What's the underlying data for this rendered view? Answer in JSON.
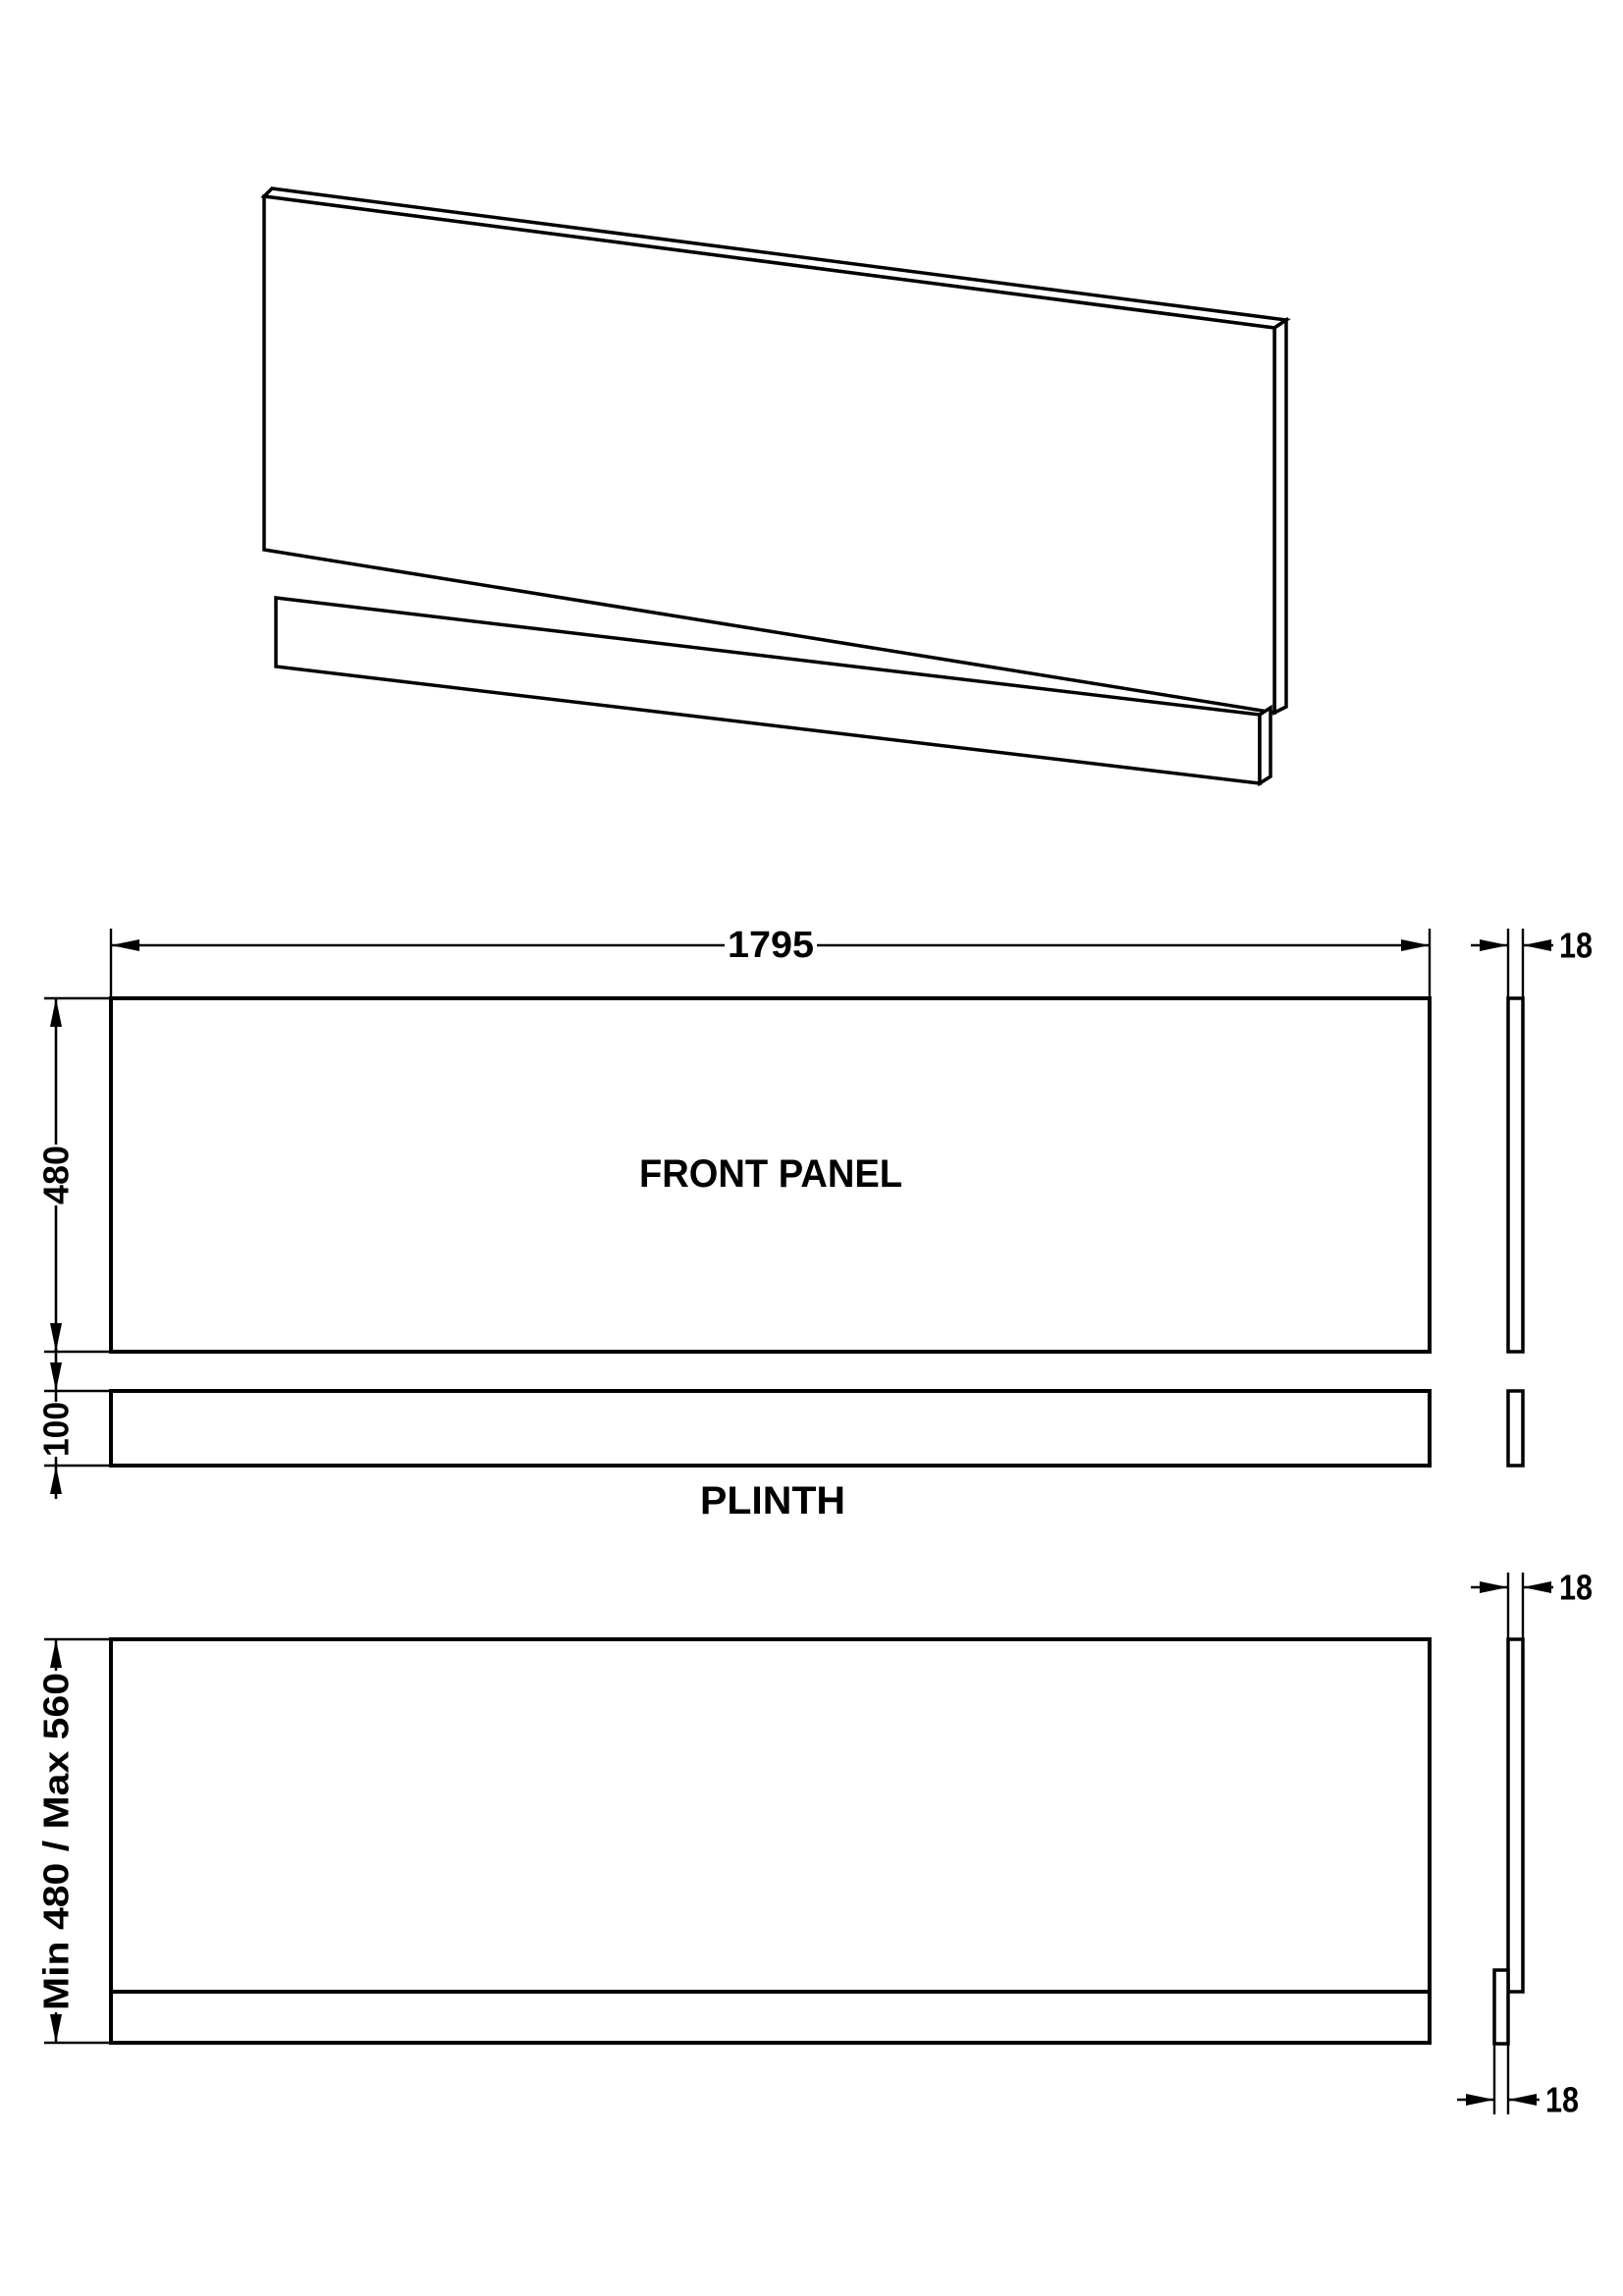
{
  "drawing": {
    "front_view": {
      "width": "1795",
      "height": "480",
      "label": "FRONT PANEL",
      "thickness": "18"
    },
    "plinth_view": {
      "height": "100",
      "label": "PLINTH"
    },
    "installed_view": {
      "height_range": "Min 480 / Max 560",
      "panel_thickness": "18",
      "plinth_thickness": "18"
    }
  }
}
